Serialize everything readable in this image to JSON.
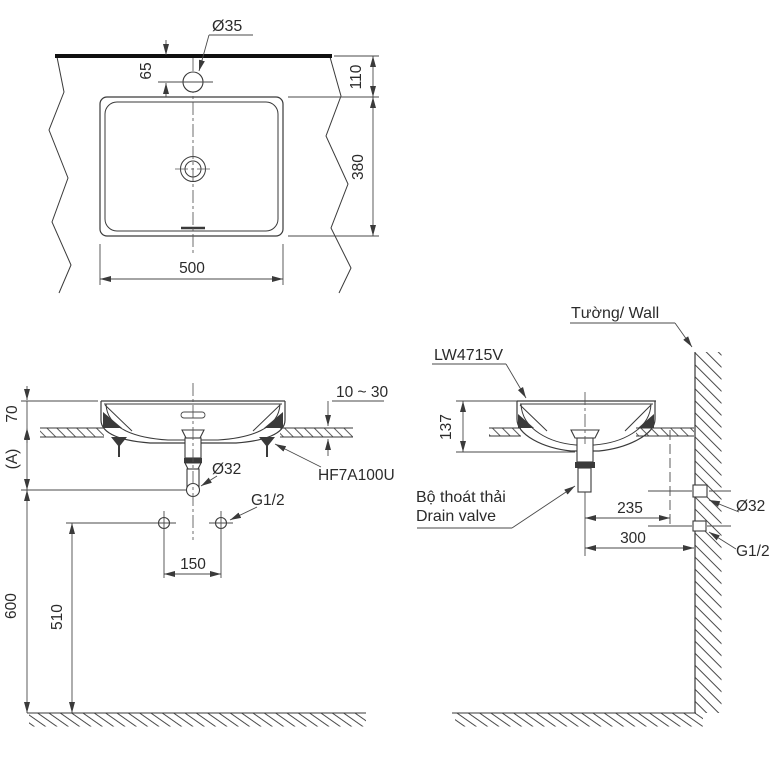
{
  "drawing": {
    "top_view": {
      "faucet_hole_dia": "Ø35",
      "hole_offset": "65",
      "edge_to_basin": "110",
      "basin_depth": "380",
      "basin_width": "500"
    },
    "front_view": {
      "rim_height": "70",
      "depth_ref": "(A)",
      "drain_height": "600",
      "supply_height": "510",
      "supply_spacing": "150",
      "counter_thickness": "10 ~ 30",
      "clamp_model": "HF7A100U",
      "drain_dia": "Ø32",
      "supply_thread": "G1/2"
    },
    "side_view": {
      "wall_label": "Tường/ Wall",
      "model": "LW4715V",
      "basin_height": "137",
      "drain_to_outlet": "235",
      "drain_to_wall": "300",
      "outlet_dia": "Ø32",
      "supply_thread": "G1/2",
      "drain_valve_vi": "Bộ thoát thải",
      "drain_valve_en": "Drain valve"
    }
  }
}
